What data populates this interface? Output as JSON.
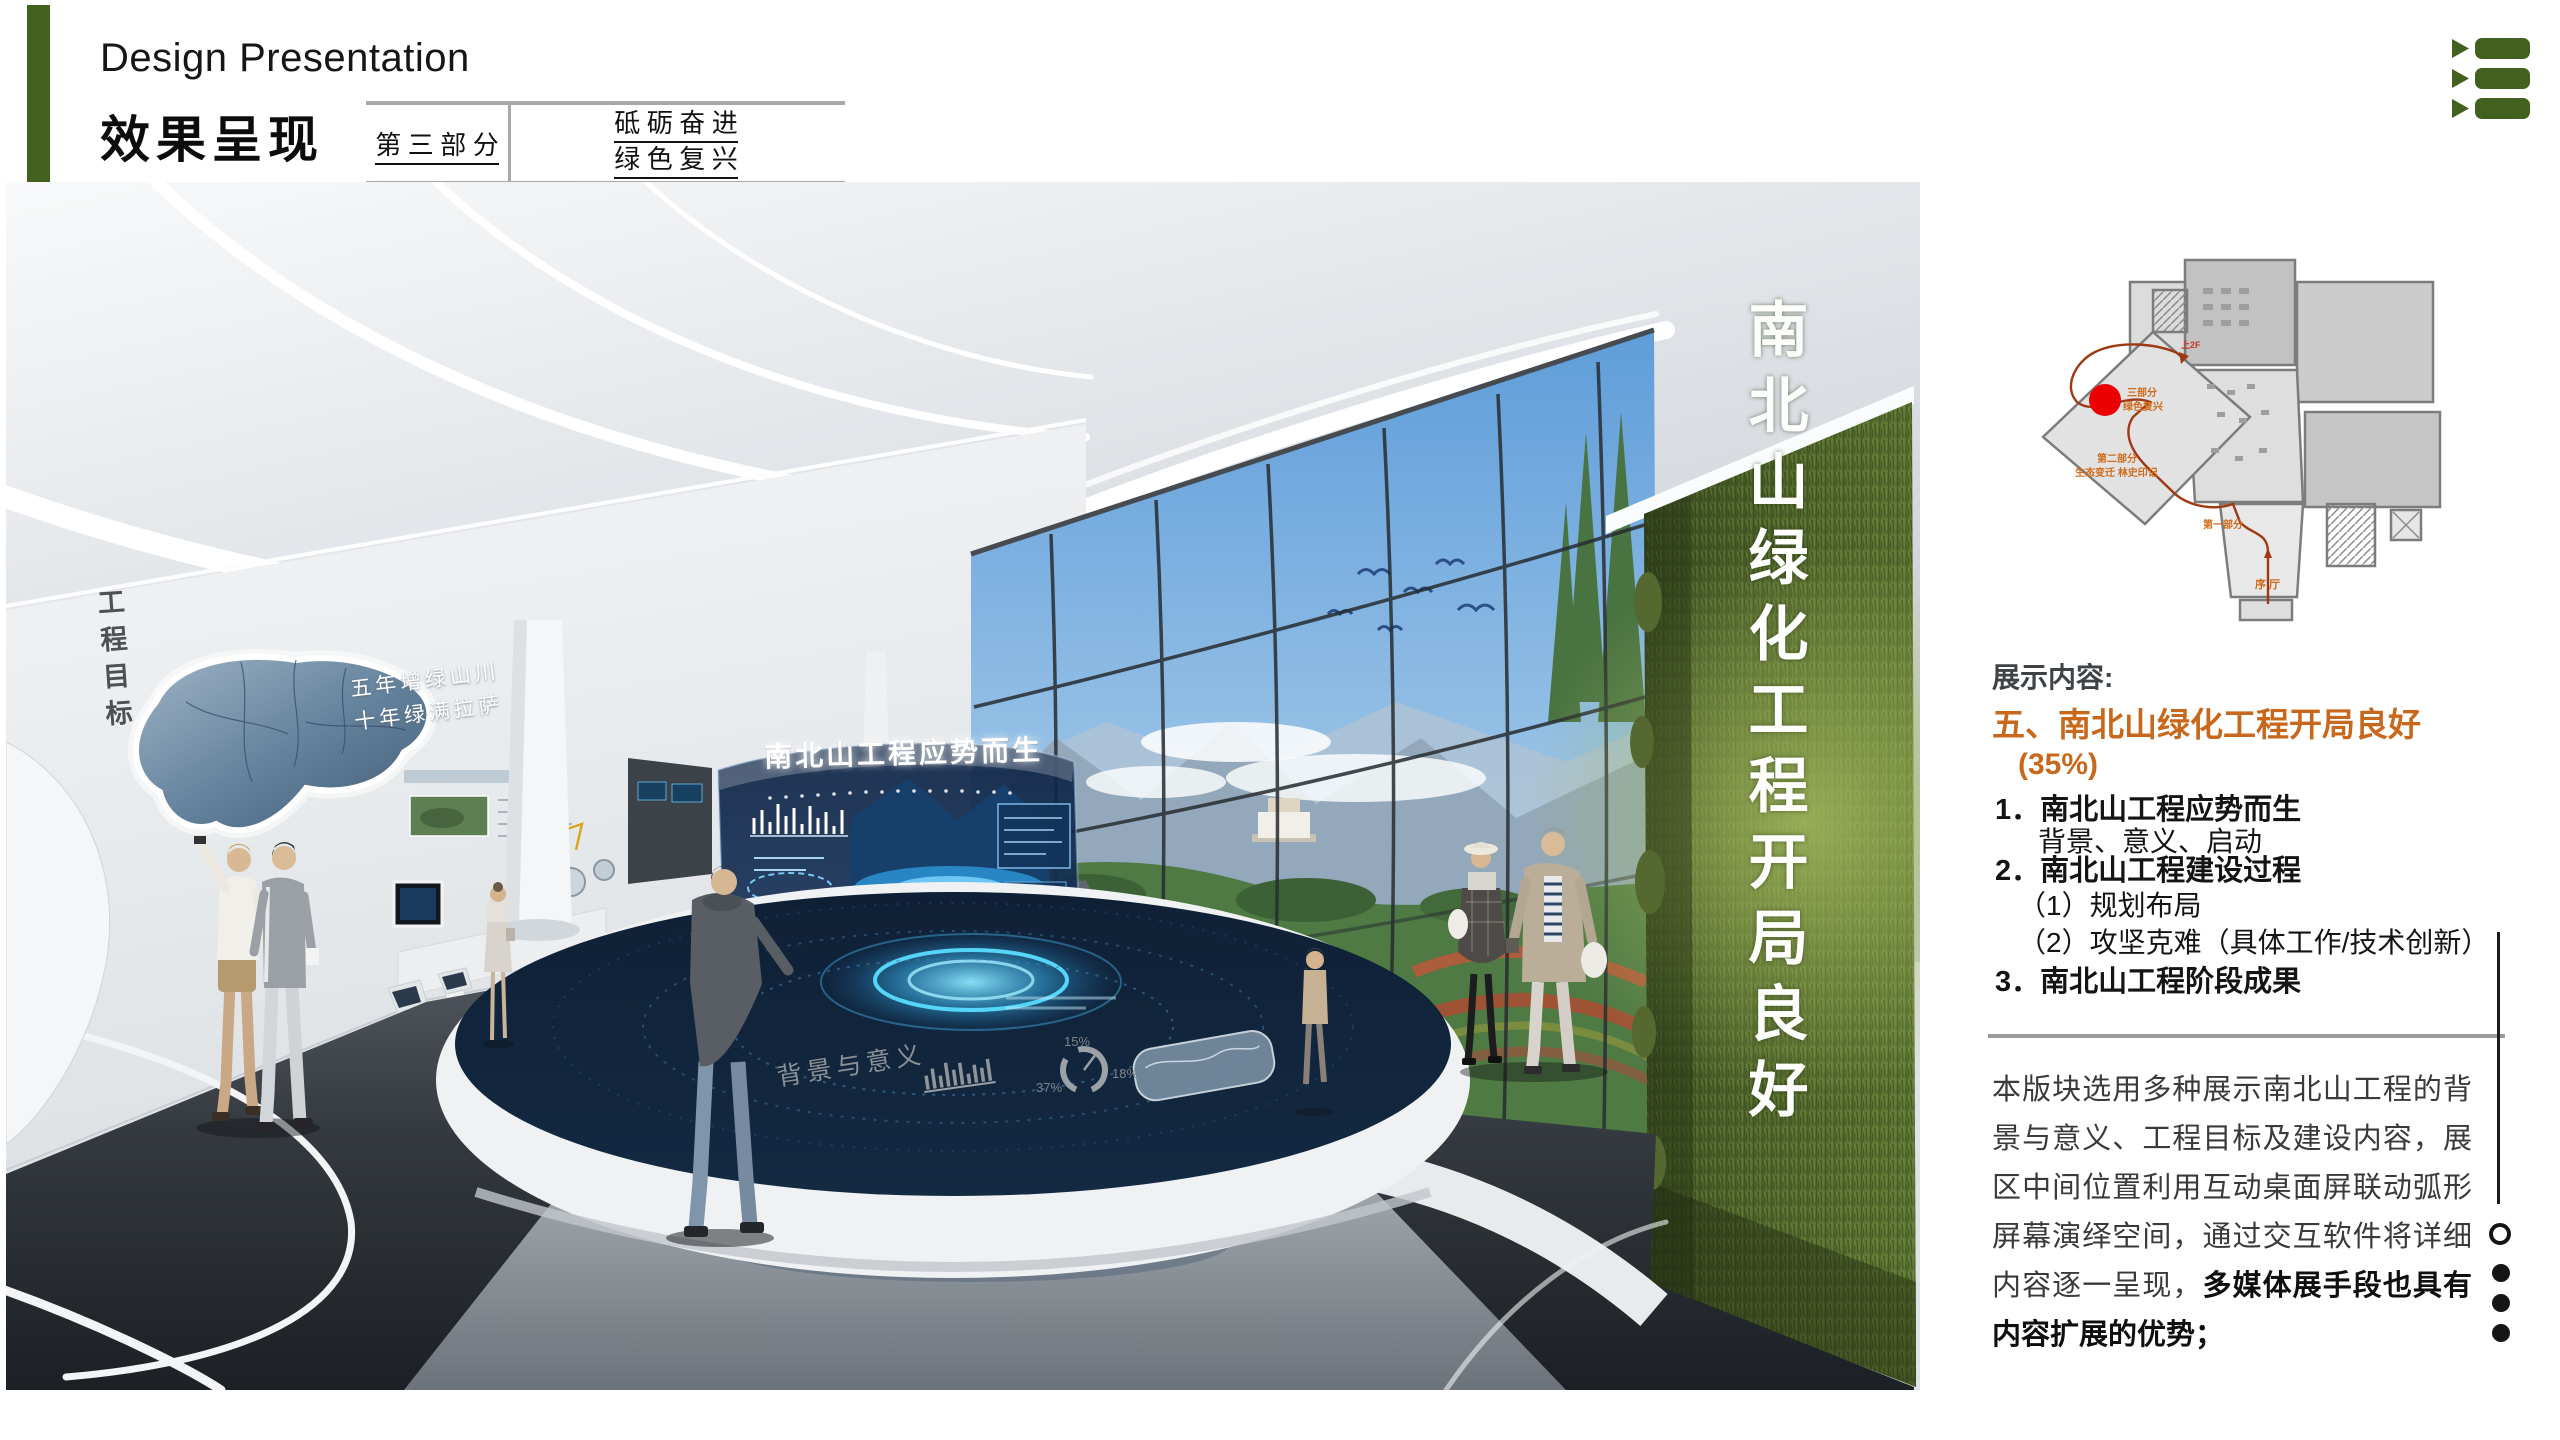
{
  "slide": {
    "bg": "#ffffff",
    "accent_green": "#42601e",
    "accent_orange": "#c7681d"
  },
  "header": {
    "subtitle_en": "Design Presentation",
    "title_cn": "效果呈现",
    "part_label": "第 三 部 分",
    "slogan_line1": "砥 砺 奋 进",
    "slogan_line2": "绿 色 复 兴"
  },
  "menu_icon": {
    "name": "list-arrows-icon",
    "color": "#42601e"
  },
  "floorplan": {
    "marker_color": "#ee0000",
    "route_color": "#9e3a12",
    "labels": {
      "part3_l1": "三部分",
      "part3_l2": "绿色复兴",
      "part2_l1": "第二部分",
      "part2_l2": "生态变迁 林史印记",
      "part1": "第一部分",
      "lobby": "序 厅",
      "up": "上2F"
    }
  },
  "rendering": {
    "left_wall_vertical": "工程目标",
    "map_slogan_line1": "五年增绿山川",
    "map_slogan_line2": "十年绿满拉萨",
    "screen_title": "南北山工程应势而生",
    "table_label": "背景与意义",
    "green_wall_vertical": "南北山绿化工程开局良好",
    "pie": {
      "p15": "15%",
      "p37": "37%",
      "p18": "18%"
    }
  },
  "content_panel": {
    "section_label": "展示内容:",
    "heading": "五、南北山绿化工程开局良好",
    "heading_pct": "(35%)",
    "items": [
      {
        "label": "1．南北山工程应势而生"
      },
      {
        "label": "背景、意义、启动"
      },
      {
        "label": "2．南北山工程建设过程"
      },
      {
        "label": "（1）规划布局"
      },
      {
        "label": "（2）攻坚克难（具体工作/技术创新）"
      },
      {
        "label": "3．南北山工程阶段成果"
      }
    ],
    "paragraph_normal": "本版块选用多种展示南北山工程的背景与意义、工程目标及建设内容，展区中间位置利用互动桌面屏联动弧形屏幕演绎空间，通过交互软件将详细内容逐一呈现，",
    "paragraph_bold": "多媒体展手段也具有内容扩展的优势；"
  }
}
